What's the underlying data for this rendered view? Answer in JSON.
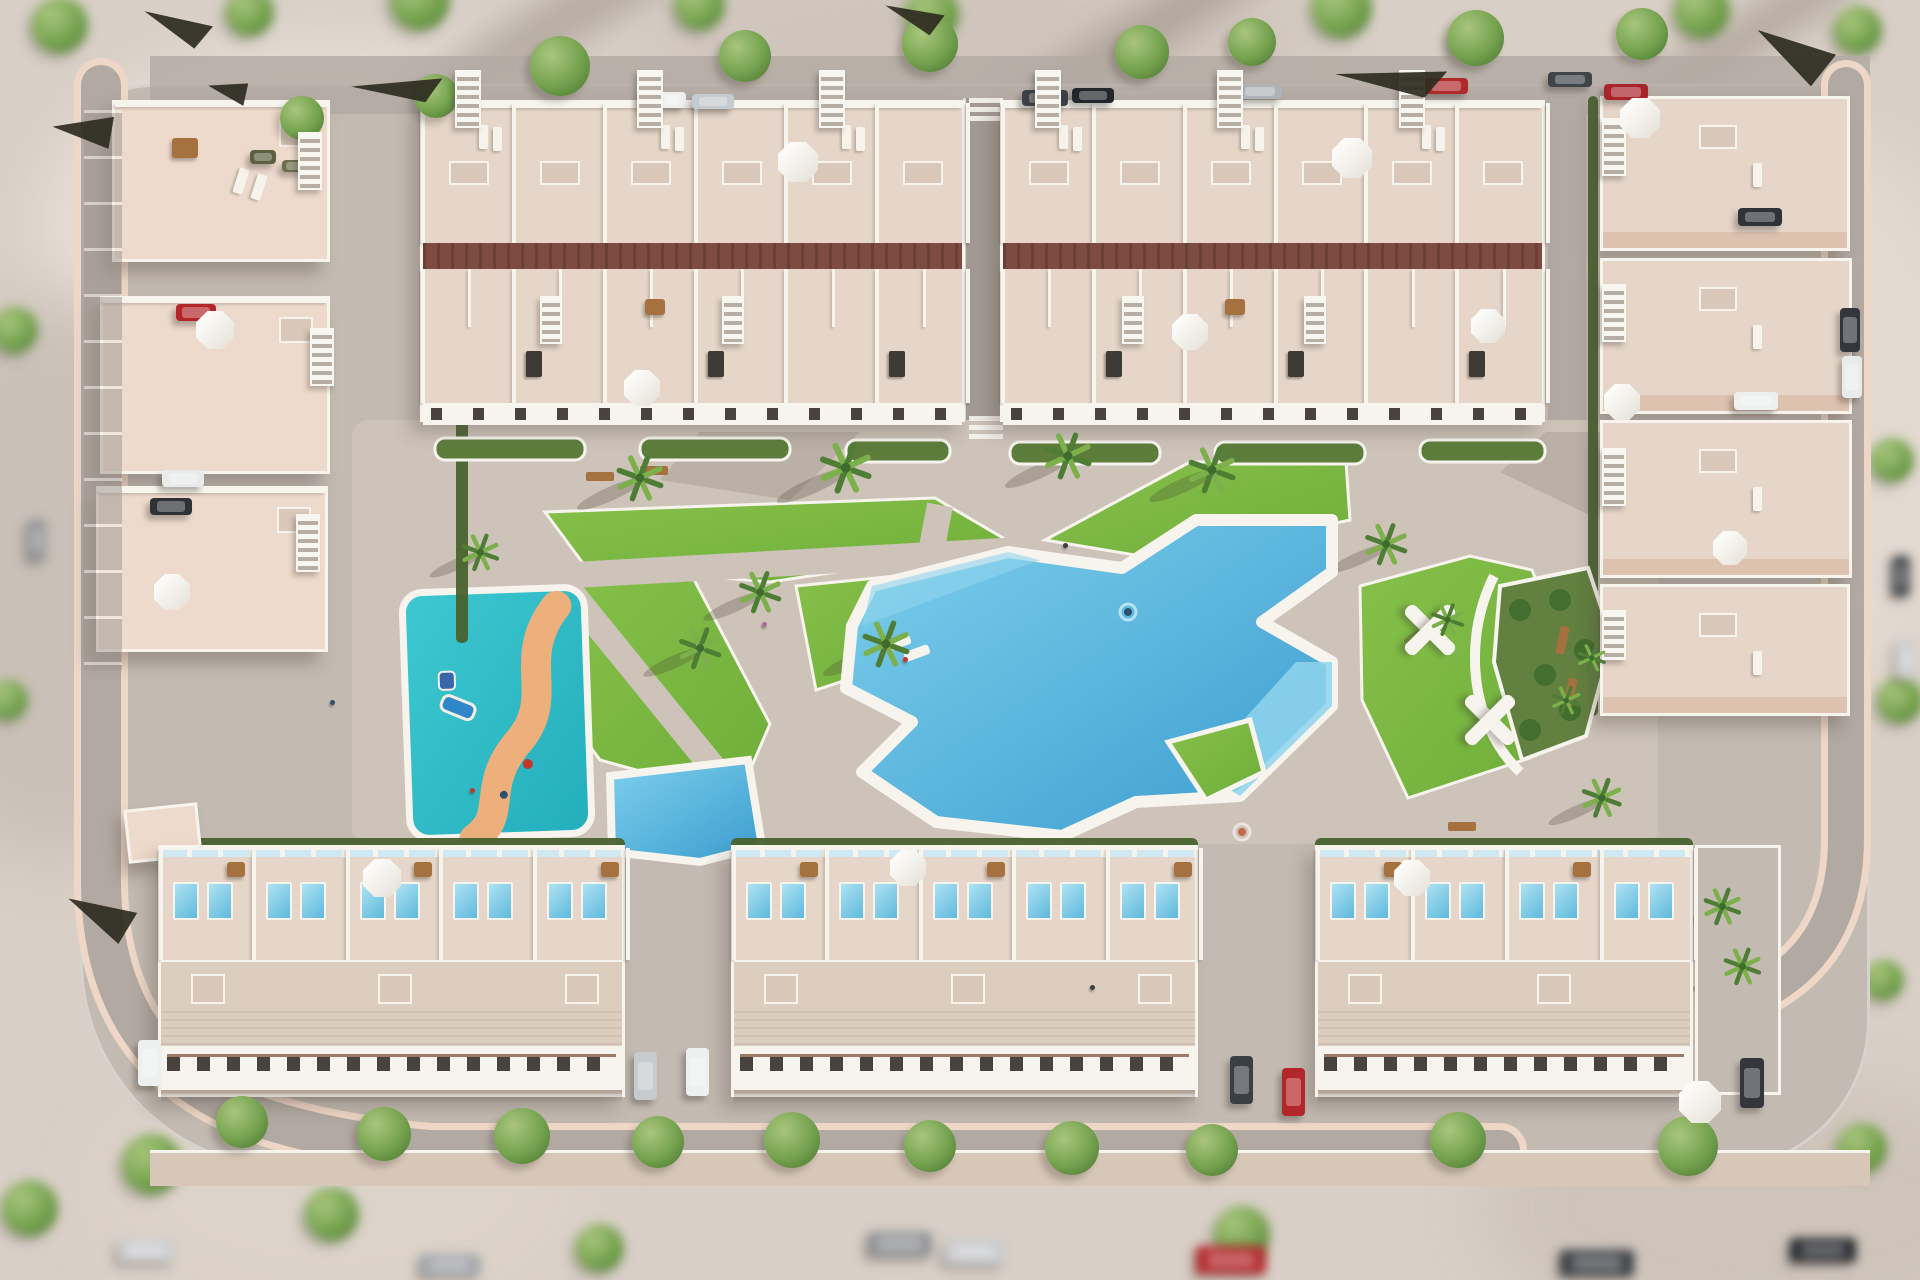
{
  "meta": {
    "title": "Aerial 3D render of a residential development with central pool park",
    "width": 1920,
    "height": 1280
  },
  "palette": {
    "ground": "#d8cfc6",
    "pave": "#c3bab1",
    "plaza": "#cdc3b9",
    "road": "#b2aaa2",
    "roadDark": "#a39b93",
    "curb": "#eed7c7",
    "white": "#f7f4ee",
    "peach": "#eedacd",
    "peachDark": "#ddc2b0",
    "roofBeige": "#dccdbf",
    "terrace": "#e6d6c9",
    "terraceDk": "#d9c8ba",
    "redStrip": "#7d4b41",
    "hedge": "#49622f",
    "lawn": "#86c04a",
    "lawnDk": "#6fae3a",
    "palm1": "#4e7d35",
    "palm2": "#7bb04a",
    "poolHi": "#8fd4ec",
    "pool": "#57b5de",
    "poolDeep": "#3a9ccf",
    "glass": "#cfe8f2",
    "kids": "#3ec8d1",
    "kidsDk": "#23aebc",
    "kidsPath": "#edb07c",
    "winDark": "#4a423c",
    "frame": "#9b7b63",
    "sidewalk": "#d7c7b8"
  },
  "scene": {
    "exterior": {
      "trees": [
        [
          60,
          25,
          28
        ],
        [
          250,
          12,
          24
        ],
        [
          420,
          0,
          30
        ],
        [
          700,
          5,
          25
        ],
        [
          932,
          14,
          27
        ],
        [
          1342,
          8,
          30
        ],
        [
          1472,
          40,
          22
        ],
        [
          1702,
          10,
          28
        ],
        [
          1858,
          30,
          24
        ],
        [
          15,
          330,
          23
        ],
        [
          8,
          700,
          20
        ],
        [
          30,
          1208,
          28
        ],
        [
          152,
          1164,
          30
        ],
        [
          332,
          1214,
          27
        ],
        [
          600,
          1248,
          24
        ],
        [
          1242,
          1234,
          28
        ],
        [
          1862,
          1148,
          25
        ],
        [
          1892,
          460,
          22
        ],
        [
          1900,
          700,
          23
        ],
        [
          1884,
          980,
          20
        ]
      ],
      "cars": [
        [
          868,
          1232,
          64,
          24,
          "#8e9094"
        ],
        [
          944,
          1240,
          60,
          24,
          "#c9cbce"
        ],
        [
          1196,
          1246,
          70,
          28,
          "#b3262a"
        ],
        [
          1560,
          1250,
          74,
          26,
          "#3a3e44"
        ],
        [
          1790,
          1238,
          66,
          24,
          "#24272c"
        ],
        [
          420,
          1254,
          60,
          22,
          "#9fa3a8"
        ],
        [
          118,
          1240,
          56,
          22,
          "#caccce"
        ],
        [
          1892,
          556,
          18,
          40,
          "#3a3e44"
        ],
        [
          1896,
          640,
          18,
          38,
          "#caccce"
        ],
        [
          28,
          520,
          18,
          40,
          "#8e9094"
        ]
      ]
    },
    "streets": {
      "topTrees": [
        [
          560,
          66,
          30
        ],
        [
          745,
          56,
          26
        ],
        [
          930,
          44,
          28
        ],
        [
          1142,
          52,
          27
        ],
        [
          1252,
          42,
          24
        ],
        [
          1476,
          38,
          28
        ],
        [
          1642,
          34,
          26
        ],
        [
          302,
          118,
          22
        ],
        [
          436,
          96,
          22
        ]
      ],
      "topCars": [
        [
          640,
          92,
          46,
          16,
          "#eef0ef"
        ],
        [
          692,
          94,
          42,
          15,
          "#c6cbcf"
        ],
        [
          1022,
          90,
          46,
          16,
          "#3c4147"
        ],
        [
          1072,
          88,
          42,
          15,
          "#23262b"
        ],
        [
          1238,
          84,
          44,
          15,
          "#aeb3b8"
        ],
        [
          1424,
          78,
          44,
          16,
          "#b02a2c"
        ],
        [
          1548,
          72,
          44,
          15,
          "#3f4449"
        ],
        [
          250,
          150,
          26,
          14,
          "#5c6040"
        ],
        [
          282,
          160,
          22,
          12,
          "#6b6f4a"
        ]
      ],
      "rightCars": [
        [
          1840,
          308,
          20,
          44,
          "#33373d"
        ],
        [
          1842,
          356,
          20,
          42,
          "#e9ebea"
        ],
        [
          1604,
          84,
          44,
          16,
          "#a8232a"
        ]
      ],
      "bottomTrees": [
        [
          242,
          1122,
          26
        ],
        [
          384,
          1134,
          27
        ],
        [
          522,
          1136,
          28
        ],
        [
          658,
          1142,
          26
        ],
        [
          792,
          1140,
          28
        ],
        [
          930,
          1146,
          26
        ],
        [
          1072,
          1148,
          27
        ],
        [
          1212,
          1150,
          26
        ],
        [
          1458,
          1140,
          28
        ],
        [
          1688,
          1146,
          30
        ]
      ]
    },
    "clusterCars": [
      [
        176,
        304,
        40,
        17,
        "#b3262a"
      ],
      [
        162,
        470,
        42,
        17,
        "#e9ebea"
      ],
      [
        150,
        498,
        42,
        17,
        "#2e3237"
      ]
    ],
    "alleyCars": [
      [
        634,
        1052,
        23,
        48,
        "#c6cbcf"
      ],
      [
        686,
        1048,
        23,
        48,
        "#eef0ef"
      ],
      [
        1230,
        1056,
        23,
        48,
        "#3a3f45"
      ],
      [
        1282,
        1068,
        23,
        48,
        "#b3262a"
      ],
      [
        138,
        1040,
        23,
        46,
        "#eef0ef"
      ],
      [
        1740,
        1058,
        24,
        50,
        "#33373d"
      ]
    ],
    "villaCars": [
      [
        1738,
        208,
        44,
        18,
        "#2f3338"
      ],
      [
        1734,
        392,
        44,
        18,
        "#eef0ef"
      ]
    ],
    "palms": [
      [
        640,
        478,
        1
      ],
      [
        846,
        468,
        1.1
      ],
      [
        1068,
        456,
        1
      ],
      [
        1212,
        470,
        1
      ],
      [
        760,
        592,
        0.9
      ],
      [
        700,
        648,
        0.9
      ],
      [
        886,
        644,
        1
      ],
      [
        480,
        552,
        0.8
      ],
      [
        1386,
        544,
        0.9
      ],
      [
        1448,
        620,
        0.7
      ],
      [
        1566,
        700,
        0.62
      ],
      [
        1592,
        658,
        0.6
      ],
      [
        1602,
        798,
        0.85
      ],
      [
        1722,
        906,
        0.8
      ],
      [
        1742,
        966,
        0.8
      ]
    ],
    "umbrellas": [
      [
        798,
        162,
        40
      ],
      [
        642,
        388,
        36
      ],
      [
        1352,
        158,
        40
      ],
      [
        1190,
        332,
        36
      ],
      [
        1488,
        326,
        34
      ],
      [
        215,
        330,
        38
      ],
      [
        172,
        592,
        36
      ],
      [
        1640,
        118,
        40
      ],
      [
        1622,
        402,
        36
      ],
      [
        1730,
        548,
        34
      ],
      [
        382,
        878,
        38
      ],
      [
        908,
        868,
        36
      ],
      [
        1412,
        878,
        36
      ],
      [
        1700,
        1102,
        42
      ]
    ],
    "stairs": [
      [
        455,
        70,
        26,
        58
      ],
      [
        637,
        70,
        26,
        58
      ],
      [
        819,
        70,
        26,
        58
      ],
      [
        1035,
        70,
        26,
        58
      ],
      [
        1217,
        70,
        26,
        58
      ],
      [
        1399,
        70,
        26,
        58
      ],
      [
        540,
        296,
        22,
        48
      ],
      [
        722,
        296,
        22,
        48
      ],
      [
        1122,
        296,
        22,
        48
      ],
      [
        1304,
        296,
        22,
        48
      ],
      [
        298,
        132,
        24,
        58
      ],
      [
        310,
        328,
        24,
        58
      ],
      [
        296,
        514,
        24,
        58
      ],
      [
        1602,
        118,
        24,
        58
      ],
      [
        1602,
        284,
        24,
        58
      ],
      [
        1602,
        448,
        24,
        58
      ],
      [
        1602,
        610,
        24,
        50
      ]
    ],
    "shades": [
      [
        352,
        80,
        92,
        26,
        -8
      ],
      [
        1336,
        70,
        112,
        30,
        -4
      ],
      [
        1752,
        38,
        82,
        44,
        12
      ],
      [
        66,
        902,
        70,
        40,
        6
      ],
      [
        56,
        118,
        62,
        36,
        -15
      ],
      [
        142,
        16,
        70,
        30,
        8
      ],
      [
        884,
        8,
        60,
        26,
        5
      ],
      [
        210,
        82,
        40,
        26,
        -10
      ]
    ],
    "people": [
      [
        1063,
        543,
        "#3a3d42"
      ],
      [
        903,
        657,
        "#c0392b"
      ],
      [
        762,
        622,
        "#b06aa0"
      ],
      [
        470,
        788,
        "#c0392b"
      ],
      [
        1090,
        985,
        "#3a3d42"
      ],
      [
        330,
        700,
        "#2e4f6e"
      ]
    ],
    "swimmers": [
      [
        1128,
        612,
        "#2e4f6e"
      ],
      [
        1242,
        832,
        "#c06a4a"
      ]
    ],
    "topBlocks": [
      {
        "x": 420,
        "y": 100,
        "w": 545,
        "units": 6
      },
      {
        "x": 1000,
        "y": 100,
        "w": 545,
        "units": 6
      }
    ],
    "leftBuildings": [
      {
        "x": 112,
        "y": 100,
        "w": 218,
        "h": 162
      },
      {
        "x": 100,
        "y": 296,
        "w": 230,
        "h": 178
      },
      {
        "x": 96,
        "y": 486,
        "w": 232,
        "h": 166
      }
    ],
    "utility": {
      "x": 126,
      "y": 806,
      "w": 74,
      "h": 54
    },
    "villas": [
      {
        "x": 1600,
        "y": 96,
        "w": 250,
        "h": 155
      },
      {
        "x": 1600,
        "y": 258,
        "w": 252,
        "h": 156
      },
      {
        "x": 1600,
        "y": 420,
        "w": 252,
        "h": 158
      },
      {
        "x": 1600,
        "y": 584,
        "w": 250,
        "h": 132
      }
    ],
    "bottomBlocks": [
      {
        "x": 158,
        "w": 467
      },
      {
        "x": 731,
        "w": 467
      },
      {
        "x": 1315,
        "w": 378,
        "drive": 86
      }
    ],
    "park": {
      "plaza": [
        352,
        420,
        1306,
        424
      ],
      "lawns": [
        "545,512 935,498 1015,545 770,582 585,566",
        "1045,540 1190,462 1346,462 1350,520 1165,560",
        "560,586 690,572 770,724 738,798 600,760 556,700",
        "796,586 936,572 906,660 816,690",
        "1360,586 1470,556 1532,570 1560,640 1530,758 1408,798 1362,700"
      ],
      "paths": [
        "M500,505 L790,862",
        "M940,505 L872,862",
        "M520,578 L1020,550"
      ],
      "pool": "872,586 1008,552 1122,568 1196,520 1332,520 1332,572 1262,622 1332,662 1332,706 1240,796 1136,802 1062,836 936,822 862,772 912,722 846,688 852,626",
      "poolSteps": "1332,662 1332,706 1240,796 1198,770 1296,662",
      "poolShallow": "872,586 1008,552 1040,560 900,612 862,626",
      "island": "1168,742 1250,720 1264,772 1206,800",
      "miniPool": "610,776 748,760 762,846 700,862 612,852",
      "kids": {
        "x": 406,
        "y": 590,
        "w": 182,
        "h": 246,
        "rot": -2,
        "path": "M560,608 C515,660 560,700 515,745 C478,788 505,815 470,838",
        "slide": [
          446,
          692
        ]
      },
      "hedges": [
        [
          158,
          838,
          467
        ],
        [
          731,
          838,
          467
        ],
        [
          1315,
          838,
          378
        ]
      ],
      "vhedges": [
        [
          456,
          298,
          12,
          345
        ],
        [
          1588,
          96,
          10,
          620
        ]
      ],
      "planters": [
        [
          435,
          438,
          150
        ],
        [
          640,
          438,
          150
        ],
        [
          846,
          440,
          104
        ],
        [
          1010,
          442,
          150
        ],
        [
          1215,
          442,
          150
        ],
        [
          1420,
          440,
          125
        ]
      ],
      "bed": "1500,586 1588,568 1612,640 1586,736 1522,760 1494,662",
      "bedPath": "M1494,576 C1462,640 1470,724 1520,772",
      "benches": [
        [
          1548,
          636,
          -78
        ],
        [
          1556,
          688,
          -78
        ],
        [
          586,
          472,
          0
        ],
        [
          640,
          466,
          0
        ],
        [
          1448,
          822,
          0
        ]
      ],
      "xperg": [
        [
          1398,
          598
        ],
        [
          1458,
          688
        ]
      ],
      "shadowPatches": [
        "1546,432 1660,432 1600,520 1500,472",
        "700,432 860,432 790,500 660,480",
        "1050,700 1160,660 1120,780 1020,770"
      ],
      "crosswalks": [
        [
          966,
          416
        ],
        [
          966,
          98
        ]
      ],
      "roads": {
        "leftPath": "M101,85 L101,880 Q101,1062 262,1118 Q336,1142 430,1150 L1500,1150",
        "rightPath": "M1846,85 L1846,838 Q1846,962 1738,1002",
        "topBand": [
          150,
          56,
          1720,
          58
        ],
        "sidewalk": [
          150,
          1150,
          1720,
          36
        ],
        "central": [
          963,
          98,
          40,
          344
        ],
        "rightStreet": [
          1548,
          96,
          38,
          622
        ]
      }
    }
  }
}
